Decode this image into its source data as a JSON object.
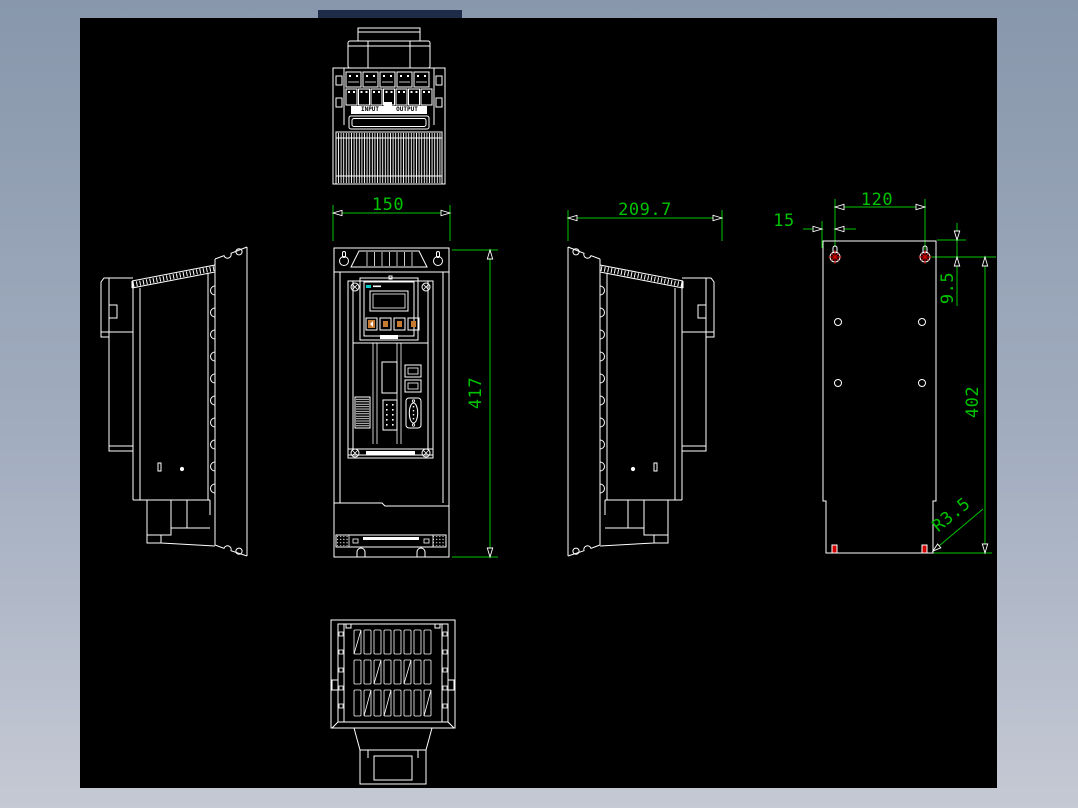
{
  "theme": {
    "border_top_color": "#8897ac",
    "border_bottom_color": "#c5c9d4",
    "canvas_color": "#000000",
    "line_color": "#ffffff",
    "dimension_color": "#00c300",
    "accent_red": "#d40000",
    "accent_cyan": "#00cccc",
    "accent_orange": "#c87a30"
  },
  "views": {
    "top": {
      "label_input": "INPUT",
      "label_output": "OUTPUT"
    },
    "front": {
      "name": "front view with keypad"
    },
    "left": {
      "name": "left side view"
    },
    "right": {
      "name": "right side view"
    },
    "plate": {
      "name": "mounting plate view"
    },
    "bottom": {
      "name": "bottom view"
    }
  },
  "dimensions": {
    "front_width": "150",
    "side_depth": "209.7",
    "front_height": "417",
    "mount_hole_spacing_horizontal": "120",
    "mount_hole_edge_offset": "15",
    "mount_hole_top_offset": "9.5",
    "mount_hole_spacing_vertical": "402",
    "mount_corner_radius": "R3.5"
  }
}
